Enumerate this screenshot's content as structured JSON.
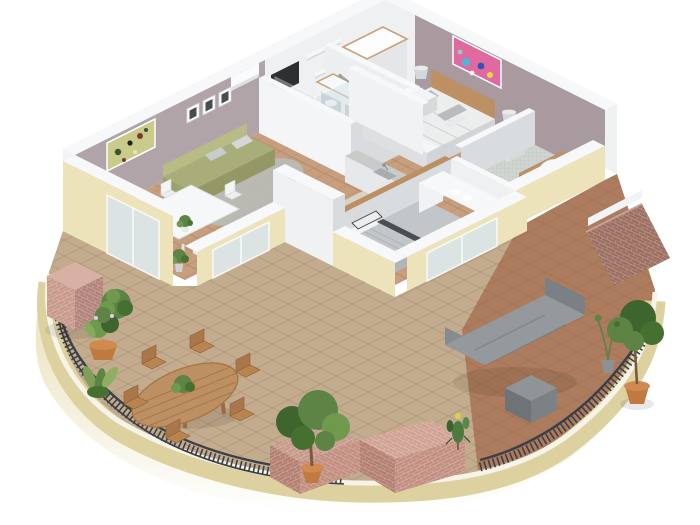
{
  "meta": {
    "title": "3D isometric cutaway floor plan of a two-bedroom apartment with wrap-around curved terrace",
    "view": "axonometric top-down render",
    "background": "#ffffff"
  },
  "palette": {
    "background": "#ffffff",
    "wall_white_face": "#eef0f2",
    "wall_white_top": "#f7f8f9",
    "wall_white_shade": "#d9dcdf",
    "wall_mauve": "#b1a4a9",
    "floor_wood": "#c79f7f",
    "floor_kitchen": "#d8d3c9",
    "floor_mosaic": "#cfd5d1",
    "rug_grey": "#b8bbb6",
    "sofa_green": "#a8ad79",
    "glass": "#d9e5ea",
    "counter_grey": "#c9cbca",
    "wood_furniture": "#bd9064",
    "linen_white": "#eceded",
    "duvet_grey": "#c3c6c9",
    "terrace_cream": "#ece3ba",
    "terrace_cream_dark": "#ddd1a0",
    "tile_tan": "#c3ab8e",
    "tile_red": "#ad7c5e",
    "brick_pink": "#c6998b",
    "brick_dark": "#9c6f60",
    "railing": "#3b4046",
    "pot_terracotta": "#bf7a40",
    "plant_green": "#5d8345",
    "plant_dark": "#3f652e",
    "lounge_grey": "#94999d",
    "painting_olive": "#c9cb8a",
    "painting_pink": "#e06a9f",
    "lamp_grey": "#d5d8da"
  },
  "rooms": [
    {
      "name": "living-dining-room",
      "furniture": [
        "green-sofa",
        "grey-rug",
        "white-dining-table",
        "white-chairs",
        "abstract-painting",
        "picture-frames",
        "air-conditioner",
        "corner-plant"
      ]
    },
    {
      "name": "kitchen",
      "furniture": [
        "grey-counter",
        "sink",
        "wood-breakfast-bar",
        "desk-chair"
      ]
    },
    {
      "name": "bathroom",
      "furniture": [
        "glass-shower",
        "pedestal-sink",
        "towel-cabinet"
      ]
    },
    {
      "name": "hallway",
      "furniture": [
        "linen-wardrobe",
        "wall-shelves",
        "tv-recess"
      ]
    },
    {
      "name": "master-bedroom",
      "furniture": [
        "double-bed",
        "wood-headboard",
        "nightstands",
        "table-lamps",
        "colorful-painting"
      ]
    },
    {
      "name": "ensuite-bathroom",
      "furniture": [
        "wood-vanity",
        "oval-basin",
        "mosaic-floor"
      ]
    },
    {
      "name": "second-bedroom",
      "furniture": [
        "grey-bed",
        "striped-pillows",
        "linen-shelf-unit"
      ]
    },
    {
      "name": "terrace",
      "furniture": [
        "wood-dining-table",
        "wood-chairs",
        "metal-railing",
        "brick-pillar",
        "brick-planters",
        "potted-trees",
        "topiary",
        "cactus",
        "grey-lounge",
        "grey-ottoman-cube"
      ]
    }
  ]
}
